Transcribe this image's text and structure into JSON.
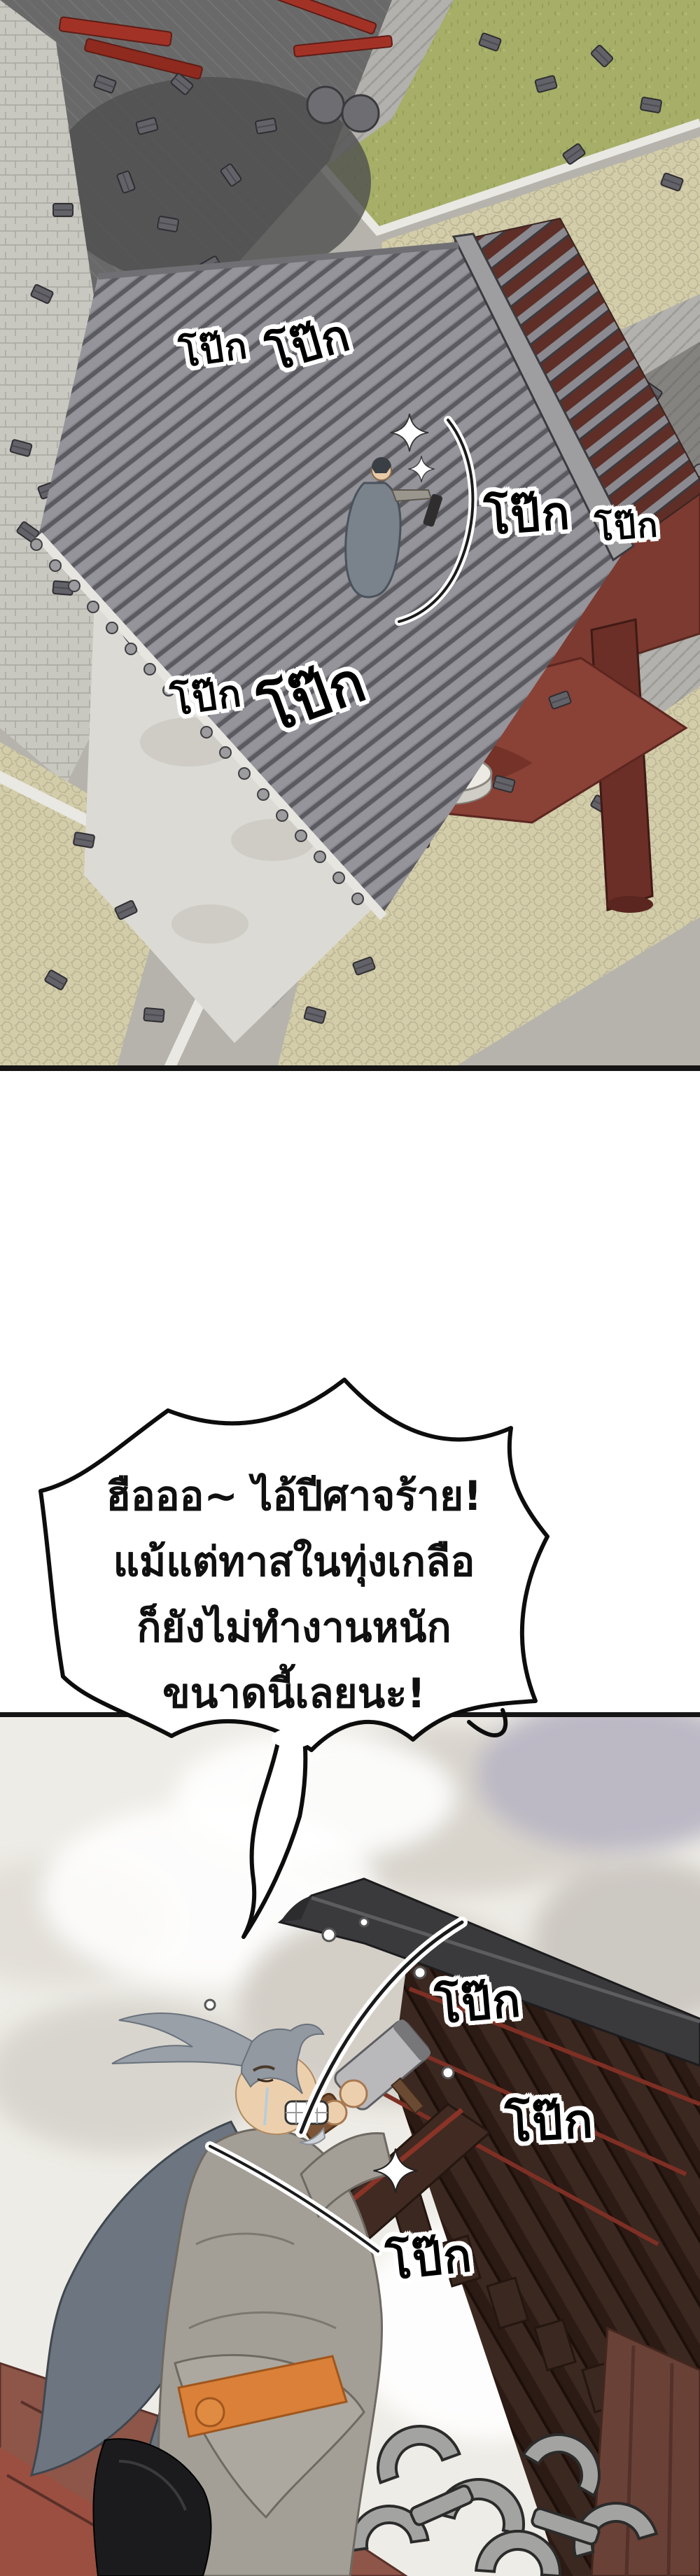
{
  "page": {
    "kind": "webtoon comic page",
    "language": "th",
    "background": "#ffffff"
  },
  "panels": {
    "top": {
      "description": "aerial isometric view of a temple courtyard under repair: gray tiled roof, red wooden frame, scattered roof tiles, grass and stone pavements, tiny cloaked worker hammering on the eave",
      "sfx": [
        {
          "words": [
            "โป๊ก",
            "โป๊ก"
          ]
        },
        {
          "words": [
            "โป๊ก",
            "โป๊ก"
          ]
        },
        {
          "words": [
            "โป๊ก",
            "โป๊ก"
          ]
        }
      ]
    },
    "bottom": {
      "description": "old gray-haired man in gray robe with orange sash kneeling on roof planks, swinging a mallet at a dark roof beam against a cloudy sky",
      "sfx": [
        {
          "text": "โป๊ก"
        },
        {
          "text": "โป๊ก"
        },
        {
          "text": "โป๊ก"
        }
      ]
    }
  },
  "speech_bubble": {
    "shape": "spiky shout bubble with tail pointing down to the old man",
    "lines": [
      "ฮือออ~ ไอ้ปีศาจร้าย!",
      "แม้แต่ทาสในทุ่งเกลือ",
      "ก็ยังไม่ทำงานหนัก",
      "ขนาดนี้เลยนะ!"
    ]
  },
  "colors": {
    "sfx_fill": "#000000",
    "sfx_outline": "#ffffff",
    "bubble_fill": "#ffffff",
    "bubble_stroke": "#000000",
    "roof_tile_gray": "#87878a",
    "wood_red": "#7c3a31",
    "grass_green": "#a6ae68",
    "pavement_dark": "#686868",
    "cobble_tan": "#d3cda9",
    "sky_cloud": "#d8d4cc",
    "dark_roof": "#3a3a3c",
    "rafter_brown": "#462b24",
    "robe_gray": "#a39f96",
    "cape_gray": "#6d7580",
    "sash_orange": "#da8038"
  }
}
